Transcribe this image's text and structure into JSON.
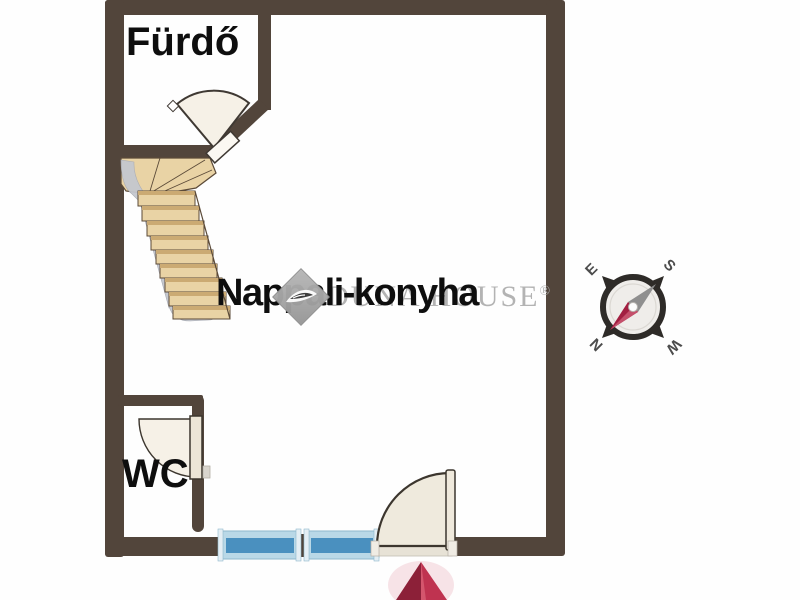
{
  "floorplan": {
    "rooms": [
      {
        "id": "furdo",
        "label": "Fürdő"
      },
      {
        "id": "nappali-konyha",
        "label": "Nappali-konyha"
      },
      {
        "id": "wc",
        "label": "WC"
      }
    ],
    "features": {
      "staircase": "winder-staircase",
      "doors": [
        "bathroom-door",
        "wc-door",
        "entrance-door"
      ],
      "windows_count": 2,
      "entrance_marker": "entrance-arrow-up"
    }
  },
  "watermark": {
    "brand": "DUNA HOUSE",
    "registered_mark": "®",
    "logo": "duna-house-diamond-logo"
  },
  "compass": {
    "label_east": "E",
    "label_south": "S",
    "label_north": "N",
    "label_west": "W"
  },
  "colors": {
    "wall": "#52453b",
    "window_glass": "#4a90bf",
    "window_frame": "#b9d8e7",
    "stair_wood": "#e9d3a5",
    "stair_stringer": "#c5c8cf",
    "door_leaf": "#f6f1e7",
    "entrance_arrow_dark": "#8c2038",
    "entrance_arrow_light": "#bf3350",
    "compass_needle_north": "#a21f41",
    "compass_needle_south": "#8f8f8f",
    "label_text": "#0e0e0e",
    "watermark_gray": "#b3b3b3"
  }
}
